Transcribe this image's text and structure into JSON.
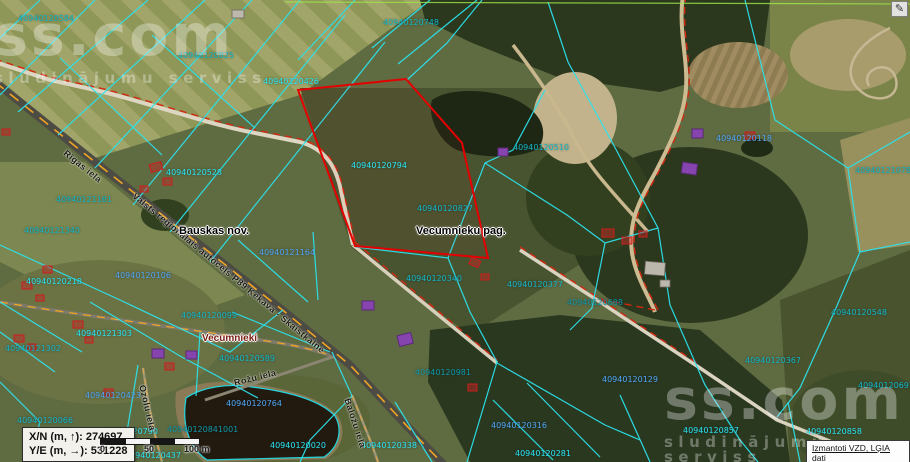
{
  "watermark": {
    "brand": "ss.com",
    "tagline": "sludinājumu serviss"
  },
  "toolbar": {
    "edit_icon": "✎"
  },
  "coordinate_readout": {
    "line1": "X/N (m, ↑): 274697",
    "line2": "Y/E (m, →): 531228"
  },
  "scale_bar": {
    "start": "0",
    "mid": "50",
    "end": "100 m"
  },
  "attribution": {
    "link_text": "Izmantoti VZD, LĢIA dati"
  },
  "map": {
    "highlighted_parcel": "40940120794",
    "colors": {
      "parcel_line": "#2ae4f2",
      "highlight": "#e40000",
      "boundary": "#d42810",
      "road_dash": "#f0a420"
    },
    "admin_labels": [
      {
        "text": "Bauskas nov.",
        "x": 179,
        "y": 225,
        "variant": "nov"
      },
      {
        "text": "Vecumnieku pag.",
        "x": 416,
        "y": 225,
        "variant": "nov"
      },
      {
        "text": "Vecumnieki",
        "x": 202,
        "y": 333,
        "variant": "village"
      }
    ],
    "road_labels": [
      {
        "text": "Rīgas iela",
        "x": 68,
        "y": 148,
        "rot": 39
      },
      {
        "text": "Valsts reģionālais autoceļš P89 Ķekava - Skaistkalne",
        "x": 137,
        "y": 191,
        "rot": 39.5
      },
      {
        "text": "Rožu iela",
        "x": 233,
        "y": 378,
        "rot": -14
      },
      {
        "text": "Ozolu iela",
        "x": 147,
        "y": 384,
        "rot": 77
      },
      {
        "text": "Baložu iela",
        "x": 352,
        "y": 397,
        "rot": 72
      }
    ],
    "parcel_labels": [
      {
        "text": "40940120584",
        "x": 18,
        "y": 14,
        "tone": "t-teal"
      },
      {
        "text": "40940120825",
        "x": 178,
        "y": 51,
        "tone": "t-teal"
      },
      {
        "text": "40940120748",
        "x": 383,
        "y": 18,
        "tone": "t-teal"
      },
      {
        "text": "40940120426",
        "x": 263,
        "y": 77,
        "tone": "t-cyan"
      },
      {
        "text": "40940120510",
        "x": 513,
        "y": 143,
        "tone": "t-teal"
      },
      {
        "text": "40940120118",
        "x": 716,
        "y": 134,
        "tone": "t-blue"
      },
      {
        "text": "40940121078",
        "x": 855,
        "y": 166,
        "tone": "t-teal"
      },
      {
        "text": "40940120528",
        "x": 166,
        "y": 168,
        "tone": "t-cyan"
      },
      {
        "text": "40940120794",
        "x": 351,
        "y": 161,
        "tone": "t-cyan"
      },
      {
        "text": "40940121161",
        "x": 56,
        "y": 195,
        "tone": "t-teal"
      },
      {
        "text": "40940120827",
        "x": 417,
        "y": 204,
        "tone": "t-teal"
      },
      {
        "text": "40940121340",
        "x": 24,
        "y": 226,
        "tone": "t-teal"
      },
      {
        "text": "40940121164",
        "x": 259,
        "y": 248,
        "tone": "t-blue"
      },
      {
        "text": "40940120106",
        "x": 115,
        "y": 271,
        "tone": "t-blue"
      },
      {
        "text": "40940120218",
        "x": 26,
        "y": 277,
        "tone": "t-cyan"
      },
      {
        "text": "40940120340",
        "x": 406,
        "y": 274,
        "tone": "t-teal"
      },
      {
        "text": "40940120377",
        "x": 507,
        "y": 280,
        "tone": "t-teal"
      },
      {
        "text": "40940120688",
        "x": 567,
        "y": 298,
        "tone": "t-dark"
      },
      {
        "text": "40940120548",
        "x": 831,
        "y": 308,
        "tone": "t-teal"
      },
      {
        "text": "40940120099",
        "x": 181,
        "y": 311,
        "tone": "t-teal"
      },
      {
        "text": "40940121303",
        "x": 76,
        "y": 329,
        "tone": "t-cyan"
      },
      {
        "text": "40940121302",
        "x": 5,
        "y": 344,
        "tone": "t-teal"
      },
      {
        "text": "40940120589",
        "x": 219,
        "y": 354,
        "tone": "t-teal"
      },
      {
        "text": "40940120367",
        "x": 745,
        "y": 356,
        "tone": "t-teal"
      },
      {
        "text": "40940120981",
        "x": 415,
        "y": 368,
        "tone": "t-dark"
      },
      {
        "text": "40940120129",
        "x": 602,
        "y": 375,
        "tone": "t-blue"
      },
      {
        "text": "40940120691",
        "x": 858,
        "y": 381,
        "tone": "t-teal"
      },
      {
        "text": "40940120423",
        "x": 85,
        "y": 391,
        "tone": "t-blue"
      },
      {
        "text": "40940120764",
        "x": 226,
        "y": 399,
        "tone": "t-blue"
      },
      {
        "text": "40940120066",
        "x": 17,
        "y": 416,
        "tone": "t-teal"
      },
      {
        "text": "40940120841001",
        "x": 167,
        "y": 425,
        "tone": "t-dark"
      },
      {
        "text": "40940120790",
        "x": 102,
        "y": 427,
        "tone": "t-cyan"
      },
      {
        "text": "40940120316",
        "x": 491,
        "y": 421,
        "tone": "t-blue"
      },
      {
        "text": "40940120857",
        "x": 683,
        "y": 426,
        "tone": "t-cyan"
      },
      {
        "text": "40940120858",
        "x": 806,
        "y": 427,
        "tone": "t-cyan"
      },
      {
        "text": "40940120020",
        "x": 270,
        "y": 441,
        "tone": "t-cyan"
      },
      {
        "text": "40940120338",
        "x": 361,
        "y": 441,
        "tone": "t-cyan"
      },
      {
        "text": "40940120281",
        "x": 515,
        "y": 449,
        "tone": "t-cyan"
      },
      {
        "text": "40940120437",
        "x": 125,
        "y": 451,
        "tone": "t-cyan"
      }
    ]
  }
}
